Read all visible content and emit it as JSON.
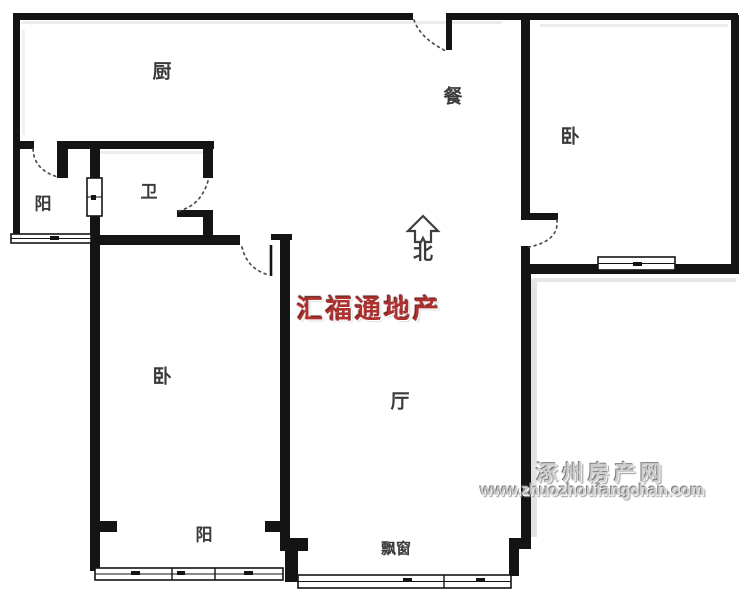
{
  "floor_plan": {
    "rooms": {
      "kitchen": "厨",
      "dining": "餐",
      "bedroom_top_right": "卧",
      "balcony_west": "阳",
      "bathroom": "卫",
      "bedroom_bottom_left": "卧",
      "living_room": "厅",
      "balcony_south": "阳",
      "bay_window": "飘窗"
    },
    "compass": {
      "north_label": "北"
    },
    "watermarks": {
      "agency": "汇福通地产",
      "site_name": "涿州房产网",
      "site_url": "www.zhuozhoufangchan.com"
    },
    "colors": {
      "wall": "#141414",
      "agency_red": "#b03030",
      "watermark_gray": "#cccccc",
      "label_text": "#3a3a3a"
    }
  }
}
